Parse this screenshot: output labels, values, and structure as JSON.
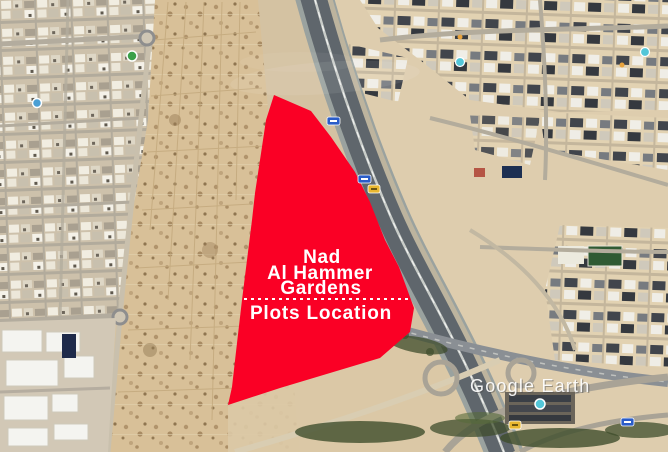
{
  "map_overlay": {
    "title_lines": [
      "Nad",
      "Al Hammer",
      "Gardens"
    ],
    "subtitle": "Plots Location",
    "polygon_color": "#fa0025",
    "text_color": "#ffffff",
    "divider_style": "dashed-white"
  },
  "watermark": {
    "label": "Google Earth",
    "color": "#ffffff"
  },
  "map": {
    "type": "satellite-aerial",
    "icons": [
      {
        "name": "poi-marker-green",
        "color": "#3aa04a"
      },
      {
        "name": "poi-marker-blue",
        "color": "#4a9fd4"
      },
      {
        "name": "poi-marker-teal",
        "color": "#53c6d8"
      },
      {
        "name": "poi-dot-orange",
        "color": "#e8a33d"
      },
      {
        "name": "route-shield-blue",
        "color": "#2a5cc8"
      },
      {
        "name": "route-shield-yellow",
        "color": "#e8b730"
      },
      {
        "name": "roundabout",
        "color": "#8e8e8e"
      }
    ],
    "palette": {
      "sand": "#d4c2a2",
      "sand_light": "#e3d3b5",
      "asphalt": "#5f666c",
      "road_light": "#b3ac9c",
      "vegetation": "#3f4d2c",
      "buildings_dark": "#41454c",
      "buildings_light": "#f0eee7"
    }
  }
}
